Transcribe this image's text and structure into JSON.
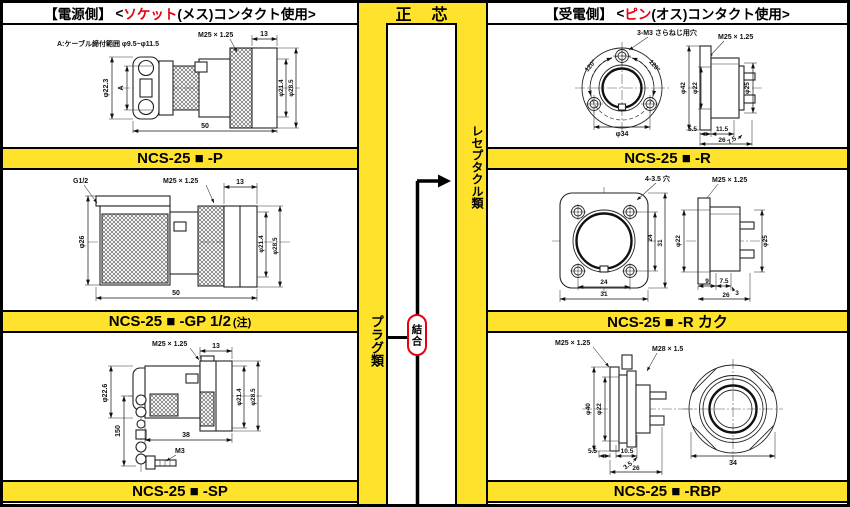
{
  "colors": {
    "yellow": "#ffe22c",
    "accent_red": "#e60012",
    "line": "#111111"
  },
  "header": {
    "left": {
      "bracket": "【電源側】",
      "pre": "<",
      "highlight": "ソケット",
      "post": "(メス)コンタクト使用>"
    },
    "center": "正　芯",
    "right": {
      "bracket": "【受電側】",
      "pre": "<",
      "highlight": "ピン",
      "post": "(オス)コンタクト使用>"
    }
  },
  "middle": {
    "plug_side": "プラグ類",
    "receptacle_side": "レセプタクル類",
    "joint": "結合"
  },
  "left_column": {
    "bars": [
      {
        "label": "NCS-25 ■ -P"
      },
      {
        "label": "NCS-25 ■ -GP 1/2",
        "note": "(注)"
      },
      {
        "label": "NCS-25 ■ -SP"
      }
    ]
  },
  "right_column": {
    "bars": [
      {
        "label": "NCS-25 ■ -R"
      },
      {
        "label": "NCS-25 ■ -R カク"
      },
      {
        "label": "NCS-25 ■ -RBP"
      }
    ]
  },
  "drawings": {
    "p": {
      "note": "A:ケーブル締付範囲 φ9.5~φ11.5",
      "thread": "M25 × 1.25",
      "len13": "13",
      "dia223": "φ22.3",
      "a": "A",
      "dia214": "φ21.4",
      "dia285": "φ28.5",
      "len50": "50"
    },
    "gp": {
      "g": "G1/2",
      "thread": "M25 × 1.25",
      "len13": "13",
      "dia26": "φ26",
      "dia214": "φ21.4",
      "dia285": "φ28.5",
      "len50": "50"
    },
    "sp": {
      "thread": "M25 × 1.25",
      "len13": "13",
      "dia226": "φ22.6",
      "len150": "150",
      "len38": "38",
      "m3": "M3",
      "dia214": "φ21.4",
      "dia285": "φ28.5"
    },
    "r": {
      "holes": "3-M3 さらねじ用穴",
      "thread": "M25 × 1.25",
      "a1": "120°",
      "a2": "120°",
      "dia34": "φ34",
      "dia42": "φ42",
      "dia22": "φ22",
      "dia25": "φ25",
      "l55": "5.5",
      "l115": "11.5",
      "l75": "7.5",
      "l26": "26"
    },
    "rk": {
      "holes": "4-3.5 穴",
      "thread": "M25 × 1.25",
      "v24": "24",
      "v31": "31",
      "dia22": "φ22",
      "dia25": "φ25",
      "h24": "24",
      "h31": "31",
      "l9": "9",
      "l75": "7.5",
      "l3": "3",
      "l26": "26"
    },
    "rbp": {
      "thread": "M25 × 1.25",
      "thread2": "M28 × 1.5",
      "dia40": "φ40",
      "dia22": "φ22",
      "l55": "5.5",
      "l105": "10.5",
      "l35": "3.5",
      "l26": "26",
      "l34": "34"
    }
  }
}
